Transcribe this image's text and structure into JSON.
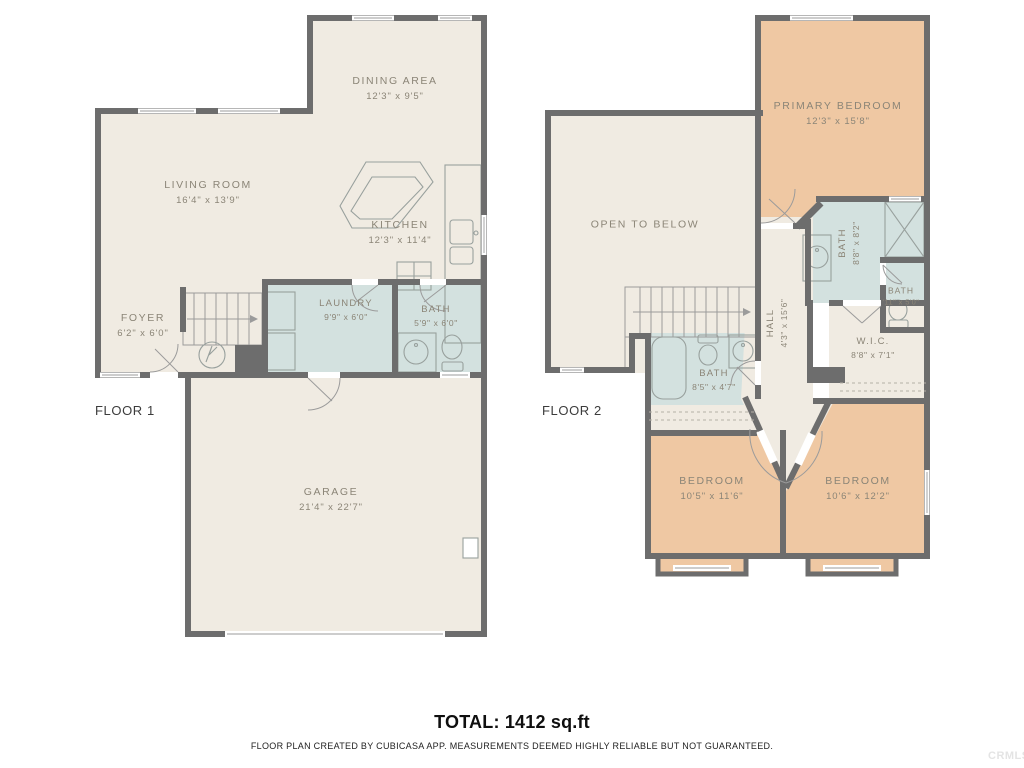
{
  "page": {
    "total": "TOTAL: 1412 sq.ft",
    "disclaimer": "FLOOR PLAN CREATED BY CUBICASA APP. MEASUREMENTS DEEMED HIGHLY RELIABLE BUT NOT GUARANTEED.",
    "watermark": "CRMLS",
    "colors": {
      "wall": "#6d6d6d",
      "room": "#f0ebe2",
      "wet_room": "#d3e1df",
      "bedroom": "#efc8a3",
      "label": "#8b8577"
    }
  },
  "floor1": {
    "label": "FLOOR 1",
    "rooms": {
      "dining": {
        "name": "DINING AREA",
        "dims": "12'3\" x 9'5\""
      },
      "living": {
        "name": "LIVING ROOM",
        "dims": "16'4\" x 13'9\""
      },
      "kitchen": {
        "name": "KITCHEN",
        "dims": "12'3\" x 11'4\""
      },
      "foyer": {
        "name": "FOYER",
        "dims": "6'2\" x 6'0\""
      },
      "laundry": {
        "name": "LAUNDRY",
        "dims": "9'9\" x 6'0\""
      },
      "bath": {
        "name": "BATH",
        "dims": "5'9\" x 6'0\""
      },
      "garage": {
        "name": "GARAGE",
        "dims": "21'4\" x 22'7\""
      }
    }
  },
  "floor2": {
    "label": "FLOOR 2",
    "rooms": {
      "open_to_below": {
        "name": "OPEN TO BELOW",
        "dims": ""
      },
      "primary": {
        "name": "PRIMARY BEDROOM",
        "dims": "12'3\" x 15'8\""
      },
      "bath_primary": {
        "name": "BATH",
        "dims": "8'8\" x 8'2\""
      },
      "bath_small": {
        "name": "BATH",
        "dims": "'11\" x 5'0\""
      },
      "hall": {
        "name": "HALL",
        "dims": "4'3\" x 15'6\""
      },
      "wic": {
        "name": "W.I.C.",
        "dims": "8'8\" x 7'1\""
      },
      "bath_hall": {
        "name": "BATH",
        "dims": "8'5\" x 4'7\""
      },
      "bedroom_left": {
        "name": "BEDROOM",
        "dims": "10'5\" x 11'6\""
      },
      "bedroom_right": {
        "name": "BEDROOM",
        "dims": "10'6\" x 12'2\""
      }
    }
  }
}
